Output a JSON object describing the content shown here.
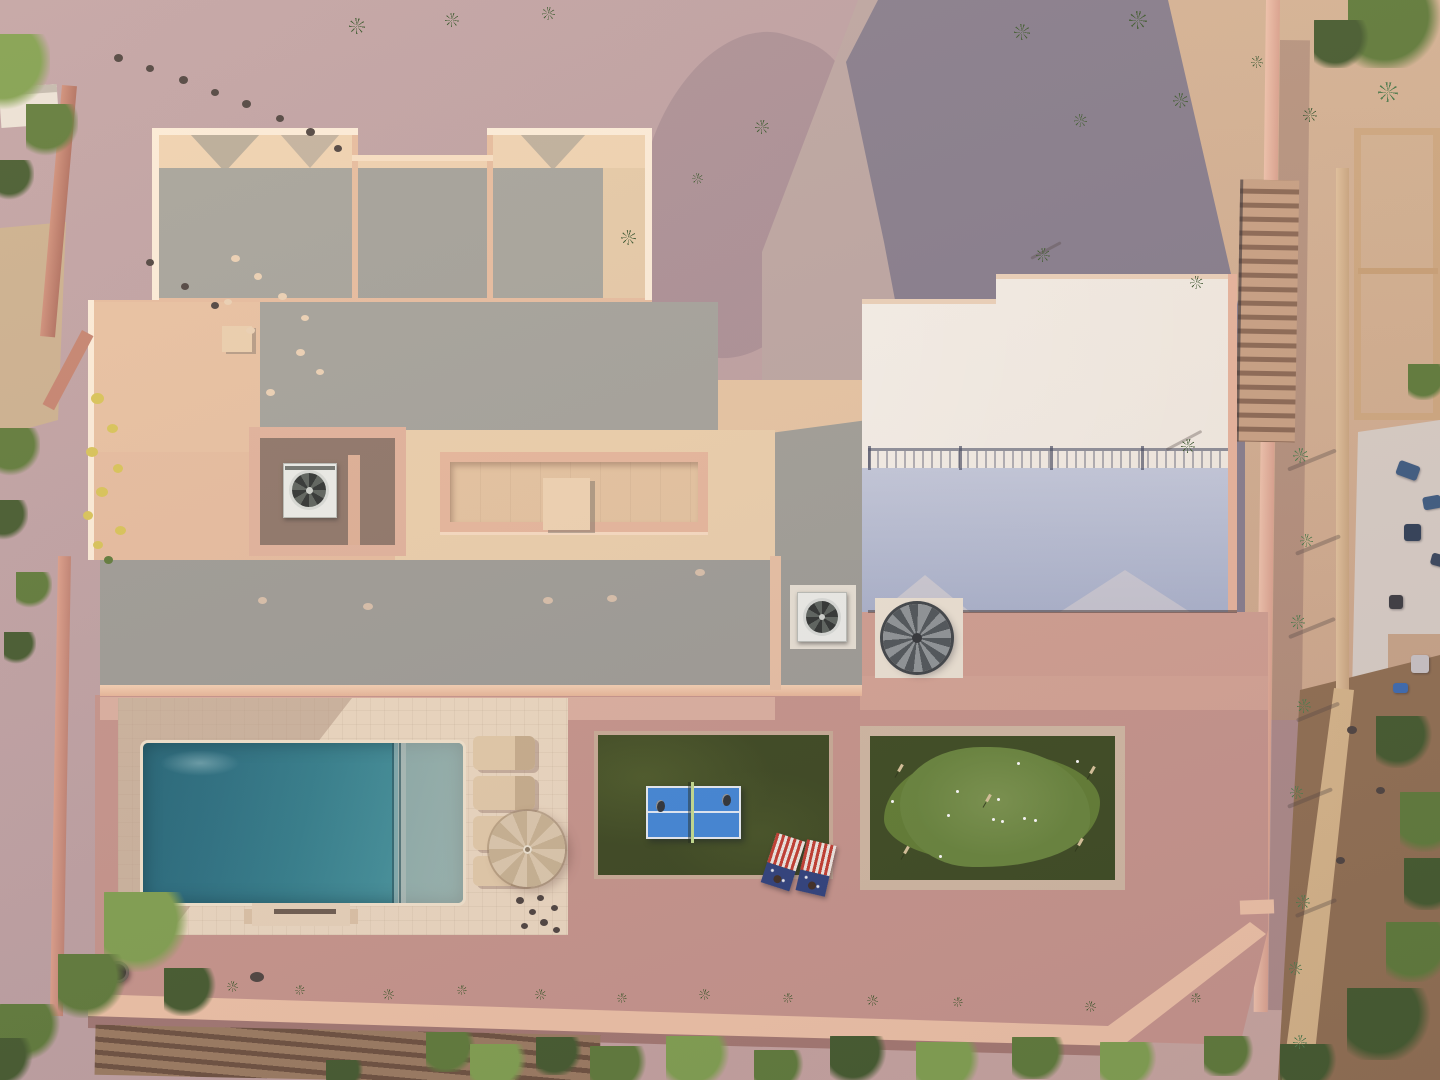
{
  "scene": {
    "type": "aerial-drone-photo",
    "subject": "desert-home-backyard",
    "objects": [
      "main-house-roof",
      "guest-house-roof",
      "paver-driveway",
      "swimming-pool",
      "baja-shelf",
      "pool-deck",
      "patio-umbrella",
      "lounge-chairs",
      "ping-pong-table",
      "cornhole-boards",
      "putting-green",
      "spiral-staircase",
      "hvac-units",
      "perimeter-walls",
      "desert-gravel",
      "trees-and-shrubs"
    ]
  },
  "palette": {
    "gravel_mauve": "#bda0a2",
    "gravel_tan": "#d4b294",
    "gravel_pink": "#c6948b",
    "paver_lit": "#bca6a2",
    "paver_shadow": "#585a7a",
    "stucco_lit": "#eec9a8",
    "stucco_bright": "#fdeeda",
    "roof_gray": "#a3a29b",
    "roof_tan": "#ead0ae",
    "white_roof": "#f3ece2",
    "white_roof_shadow": "#aab2cc",
    "pool_deep": "#206577",
    "pool_light": "#55a0a5",
    "deck": "#ecd9c1",
    "turf_dark": "#39461e",
    "green_blob": "#5f7c31",
    "pingpong_blue": "#3f86d8",
    "net_green": "#c3dd8e",
    "cornhole_red": "#c23b2e",
    "cornhole_blue": "#2c3f7c",
    "umbrella_tan": "#d8c5a8",
    "wall_pink": "#eec2a6",
    "veg_bright": "#7fa04e",
    "veg_mid": "#5d7a38",
    "veg_dark": "#42592c",
    "flower_yellow": "#d9c557",
    "plant_dark": "#3f5a33",
    "rock_dark": "#4c423e",
    "furniture_blue": "#3b5a80",
    "dapple_light": "#ecd2b5",
    "scupper_tan": "#d8c0aa",
    "agave_green": "#4c7a4a"
  },
  "scatter": [
    {
      "target": "lay-plants",
      "name": "desert-plant",
      "kind": "spike",
      "items": [
        [
          357,
          26,
          16,
          16,
          0,
          "plant_dark"
        ],
        [
          452,
          20,
          14,
          14,
          0,
          "plant_dark"
        ],
        [
          548,
          13,
          13,
          13,
          0,
          "plant_dark"
        ],
        [
          628,
          237,
          15,
          15,
          0,
          "plant_dark"
        ],
        [
          762,
          127,
          14,
          14,
          0,
          "plant_dark"
        ],
        [
          697,
          178,
          11,
          11,
          0,
          "plant_dark"
        ],
        [
          1022,
          32,
          16,
          16,
          0,
          "plant_dark"
        ],
        [
          1138,
          20,
          18,
          18,
          0,
          "plant_dark"
        ],
        [
          1080,
          120,
          13,
          13,
          0,
          "plant_dark"
        ],
        [
          1043,
          255,
          14,
          14,
          0,
          "plant_dark"
        ],
        [
          1180,
          100,
          15,
          15,
          0,
          "plant_dark"
        ],
        [
          1196,
          282,
          13,
          13,
          0,
          "plant_dark"
        ],
        [
          1188,
          446,
          14,
          14,
          0,
          "plant_dark"
        ],
        [
          1257,
          62,
          12,
          12,
          0,
          "plant_dark"
        ],
        [
          1310,
          115,
          14,
          14,
          0,
          "plant_dark"
        ]
      ]
    },
    {
      "target": "lay-plants",
      "name": "agave-plant",
      "kind": "spike",
      "items": [
        [
          1300,
          455,
          15,
          15,
          0,
          "agave_green"
        ],
        [
          1306,
          540,
          13,
          13,
          0,
          "agave_green"
        ],
        [
          1298,
          622,
          14,
          14,
          0,
          "agave_green"
        ],
        [
          1304,
          706,
          14,
          14,
          0,
          "agave_green"
        ],
        [
          1296,
          792,
          13,
          13,
          0,
          "agave_green"
        ],
        [
          1303,
          902,
          14,
          14,
          0,
          "agave_green"
        ],
        [
          1295,
          968,
          13,
          13,
          0,
          "agave_green"
        ],
        [
          1300,
          1042,
          14,
          14,
          0,
          "agave_green"
        ],
        [
          1388,
          92,
          20,
          20,
          0,
          "agave_green"
        ]
      ]
    },
    {
      "target": "lay-plants",
      "name": "yard-agave-row",
      "kind": "spike",
      "items": [
        [
          232,
          986,
          11,
          11,
          0,
          "veg_dark"
        ],
        [
          300,
          990,
          10,
          10,
          0,
          "veg_dark"
        ],
        [
          388,
          994,
          11,
          11,
          0,
          "veg_dark"
        ],
        [
          462,
          990,
          10,
          10,
          0,
          "veg_dark"
        ],
        [
          540,
          994,
          11,
          11,
          0,
          "veg_dark"
        ],
        [
          622,
          998,
          10,
          10,
          0,
          "veg_dark"
        ],
        [
          704,
          994,
          11,
          11,
          0,
          "veg_dark"
        ],
        [
          788,
          998,
          10,
          10,
          0,
          "veg_dark"
        ],
        [
          872,
          1000,
          11,
          11,
          0,
          "veg_dark"
        ],
        [
          958,
          1002,
          10,
          10,
          0,
          "veg_dark"
        ],
        [
          1090,
          1006,
          11,
          11,
          0,
          "veg_dark"
        ],
        [
          1196,
          998,
          10,
          10,
          0,
          "veg_dark"
        ]
      ]
    },
    {
      "target": "lay-shadows",
      "name": "plant-shadow",
      "kind": "streak",
      "items": [
        [
          1046,
          250,
          34,
          3,
          -28,
          "rock_dark"
        ],
        [
          1184,
          440,
          40,
          3,
          -28,
          "rock_dark"
        ],
        [
          1312,
          460,
          52,
          4,
          -22,
          "rock_dark"
        ],
        [
          1318,
          545,
          48,
          4,
          -22,
          "rock_dark"
        ],
        [
          1312,
          628,
          50,
          4,
          -22,
          "rock_dark"
        ],
        [
          1318,
          712,
          46,
          4,
          -22,
          "rock_dark"
        ],
        [
          1310,
          798,
          48,
          4,
          -22,
          "rock_dark"
        ],
        [
          1316,
          908,
          44,
          4,
          -22,
          "rock_dark"
        ]
      ]
    },
    {
      "target": "lay-rocks",
      "name": "rock",
      "kind": "dot",
      "items": [
        [
          118,
          58,
          9,
          8,
          0,
          "rock_dark"
        ],
        [
          150,
          68,
          8,
          7,
          0,
          "rock_dark"
        ],
        [
          183,
          80,
          9,
          8,
          0,
          "rock_dark"
        ],
        [
          215,
          92,
          8,
          7,
          0,
          "rock_dark"
        ],
        [
          246,
          104,
          9,
          8,
          0,
          "rock_dark"
        ],
        [
          280,
          118,
          8,
          7,
          0,
          "rock_dark"
        ],
        [
          310,
          132,
          9,
          8,
          0,
          "rock_dark"
        ],
        [
          338,
          148,
          8,
          7,
          0,
          "rock_dark"
        ],
        [
          150,
          262,
          8,
          7,
          0,
          "rock_dark"
        ],
        [
          185,
          286,
          8,
          7,
          0,
          "rock_dark"
        ],
        [
          215,
          305,
          8,
          7,
          0,
          "rock_dark"
        ],
        [
          1352,
          730,
          10,
          8,
          0,
          "rock_dark"
        ],
        [
          1380,
          790,
          9,
          7,
          0,
          "rock_dark"
        ],
        [
          1340,
          860,
          9,
          7,
          0,
          "rock_dark"
        ]
      ]
    },
    {
      "target": "lay-rocks",
      "name": "sun-dapple",
      "kind": "dot",
      "items": [
        [
          235,
          258,
          9,
          7,
          0,
          "dapple_light"
        ],
        [
          258,
          276,
          8,
          7,
          0,
          "dapple_light"
        ],
        [
          282,
          296,
          9,
          7,
          0,
          "dapple_light"
        ],
        [
          305,
          318,
          8,
          6,
          0,
          "dapple_light"
        ],
        [
          250,
          330,
          9,
          7,
          0,
          "dapple_light"
        ],
        [
          228,
          302,
          8,
          6,
          0,
          "dapple_light"
        ],
        [
          300,
          352,
          9,
          7,
          0,
          "dapple_light"
        ],
        [
          320,
          372,
          8,
          6,
          0,
          "dapple_light"
        ],
        [
          270,
          392,
          9,
          7,
          0,
          "dapple_light"
        ]
      ]
    },
    {
      "target": "lay-trees",
      "name": "tree",
      "kind": "blob",
      "items": [
        [
          12,
          72,
          76,
          76,
          0,
          "veg_bright"
        ],
        [
          52,
          130,
          52,
          52,
          0,
          "veg_mid"
        ],
        [
          14,
          180,
          40,
          40,
          0,
          "veg_dark"
        ],
        [
          16,
          452,
          48,
          48,
          0,
          "veg_mid"
        ],
        [
          8,
          520,
          40,
          40,
          0,
          "veg_dark"
        ],
        [
          34,
          590,
          36,
          36,
          0,
          "veg_mid"
        ],
        [
          20,
          648,
          32,
          32,
          0,
          "veg_dark"
        ],
        [
          146,
          932,
          84,
          80,
          0,
          "veg_bright"
        ],
        [
          92,
          986,
          68,
          64,
          0,
          "veg_mid"
        ],
        [
          30,
          1032,
          60,
          56,
          0,
          "veg_mid"
        ],
        [
          190,
          992,
          52,
          48,
          0,
          "veg_dark"
        ],
        [
          6,
          1062,
          56,
          48,
          0,
          "veg_dark"
        ],
        [
          1396,
          28,
          96,
          80,
          0,
          "veg_mid"
        ],
        [
          1342,
          44,
          56,
          48,
          0,
          "veg_dark"
        ],
        [
          1428,
          382,
          40,
          36,
          0,
          "veg_mid"
        ],
        [
          1404,
          742,
          56,
          52,
          0,
          "veg_dark"
        ],
        [
          1432,
          822,
          64,
          60,
          0,
          "veg_mid"
        ]
      ]
    },
    {
      "target": "lay-veg",
      "name": "shrub-row",
      "kind": "blob",
      "items": [
        [
          452,
          1052,
          52,
          40,
          0,
          "veg_mid"
        ],
        [
          500,
          1066,
          60,
          44,
          0,
          "veg_bright"
        ],
        [
          560,
          1056,
          48,
          38,
          0,
          "veg_dark"
        ],
        [
          620,
          1068,
          60,
          44,
          0,
          "veg_mid"
        ],
        [
          700,
          1060,
          68,
          48,
          0,
          "veg_bright"
        ],
        [
          780,
          1070,
          52,
          40,
          0,
          "veg_mid"
        ],
        [
          860,
          1058,
          60,
          44,
          0,
          "veg_dark"
        ],
        [
          950,
          1066,
          68,
          48,
          0,
          "veg_bright"
        ],
        [
          1040,
          1058,
          56,
          42,
          0,
          "veg_mid"
        ],
        [
          1130,
          1064,
          60,
          44,
          0,
          "veg_bright"
        ],
        [
          1230,
          1056,
          52,
          40,
          0,
          "veg_mid"
        ],
        [
          1310,
          1066,
          60,
          44,
          0,
          "veg_dark"
        ],
        [
          1390,
          1024,
          86,
          72,
          0,
          "veg_dark"
        ],
        [
          1420,
          952,
          68,
          60,
          0,
          "veg_mid"
        ],
        [
          1434,
          884,
          60,
          52,
          0,
          "veg_dark"
        ],
        [
          346,
          1074,
          40,
          28,
          0,
          "veg_dark"
        ]
      ]
    },
    {
      "target": "lay-flowers",
      "name": "flower-bush",
      "kind": "dot",
      "items": [
        [
          97,
          398,
          13,
          11,
          0,
          "flower_yellow"
        ],
        [
          112,
          428,
          11,
          9,
          0,
          "flower_yellow"
        ],
        [
          92,
          452,
          12,
          10,
          0,
          "flower_yellow"
        ],
        [
          118,
          468,
          10,
          9,
          0,
          "flower_yellow"
        ],
        [
          102,
          492,
          12,
          10,
          0,
          "flower_yellow"
        ],
        [
          88,
          515,
          10,
          9,
          0,
          "flower_yellow"
        ],
        [
          120,
          530,
          11,
          9,
          0,
          "flower_yellow"
        ],
        [
          98,
          545,
          10,
          8,
          0,
          "flower_yellow"
        ],
        [
          108,
          560,
          9,
          8,
          0,
          "veg_mid"
        ]
      ]
    },
    {
      "target": "lay-green",
      "name": "golf-ball",
      "kind": "dot",
      "items": [
        [
          1018,
          763,
          3,
          3,
          0,
          "#ffffff"
        ],
        [
          1077,
          761,
          3,
          3,
          0,
          "#ffffff"
        ],
        [
          957,
          791,
          3,
          3,
          0,
          "#ffffff"
        ],
        [
          998,
          799,
          3,
          3,
          0,
          "#ffffff"
        ],
        [
          1024,
          818,
          3,
          3,
          0,
          "#ffffff"
        ],
        [
          993,
          819,
          3,
          3,
          0,
          "#ffffff"
        ],
        [
          1002,
          821,
          3,
          3,
          0,
          "#ffffff"
        ],
        [
          1035,
          820,
          3,
          3,
          0,
          "#ffffff"
        ],
        [
          892,
          801,
          3,
          3,
          0,
          "#ffffff"
        ],
        [
          948,
          815,
          3,
          3,
          0,
          "#ffffff"
        ],
        [
          940,
          856,
          3,
          3,
          0,
          "#ffffff"
        ]
      ]
    },
    {
      "target": "lay-green",
      "name": "putting-flag",
      "kind": "flag",
      "items": [
        [
          900,
          768,
          3,
          8,
          30,
          "#d8c49a"
        ],
        [
          1092,
          770,
          3,
          8,
          30,
          "#d8c49a"
        ],
        [
          988,
          798,
          3,
          8,
          30,
          "#d8c49a"
        ],
        [
          906,
          850,
          3,
          8,
          30,
          "#d8c49a"
        ],
        [
          1080,
          842,
          3,
          8,
          30,
          "#d8c49a"
        ]
      ]
    },
    {
      "target": "lay-pool",
      "name": "river-rocks",
      "kind": "dot",
      "items": [
        [
          520,
          900,
          8,
          7,
          0,
          "rock_dark"
        ],
        [
          532,
          912,
          7,
          6,
          0,
          "rock_dark"
        ],
        [
          544,
          922,
          8,
          7,
          0,
          "rock_dark"
        ],
        [
          554,
          908,
          7,
          6,
          0,
          "rock_dark"
        ],
        [
          524,
          926,
          7,
          6,
          0,
          "rock_dark"
        ],
        [
          540,
          898,
          7,
          6,
          0,
          "rock_dark"
        ],
        [
          556,
          930,
          7,
          6,
          0,
          "rock_dark"
        ]
      ]
    },
    {
      "target": "lay-house",
      "name": "roof-scupper",
      "kind": "dot",
      "items": [
        [
          368,
          606,
          10,
          7,
          0,
          "scupper_tan"
        ],
        [
          548,
          600,
          10,
          7,
          0,
          "scupper_tan"
        ],
        [
          612,
          598,
          10,
          7,
          0,
          "scupper_tan"
        ],
        [
          700,
          572,
          10,
          7,
          0,
          "scupper_tan"
        ],
        [
          262,
          600,
          9,
          7,
          0,
          "scupper_tan"
        ]
      ]
    },
    {
      "target": "lay-neighbor",
      "name": "patio-furniture",
      "kind": "box",
      "items": [
        [
          1408,
          470,
          22,
          15,
          20,
          "furniture_blue"
        ],
        [
          1432,
          502,
          18,
          13,
          -10,
          "furniture_blue"
        ],
        [
          1412,
          532,
          17,
          17,
          0,
          "#2e3e55"
        ],
        [
          1396,
          602,
          14,
          14,
          0,
          "#3a3a40"
        ],
        [
          1420,
          664,
          18,
          18,
          0,
          "#c9c4c6"
        ],
        [
          1400,
          688,
          15,
          10,
          0,
          "#3a6ab0"
        ],
        [
          1438,
          560,
          14,
          12,
          15,
          "#36455c"
        ]
      ]
    }
  ]
}
